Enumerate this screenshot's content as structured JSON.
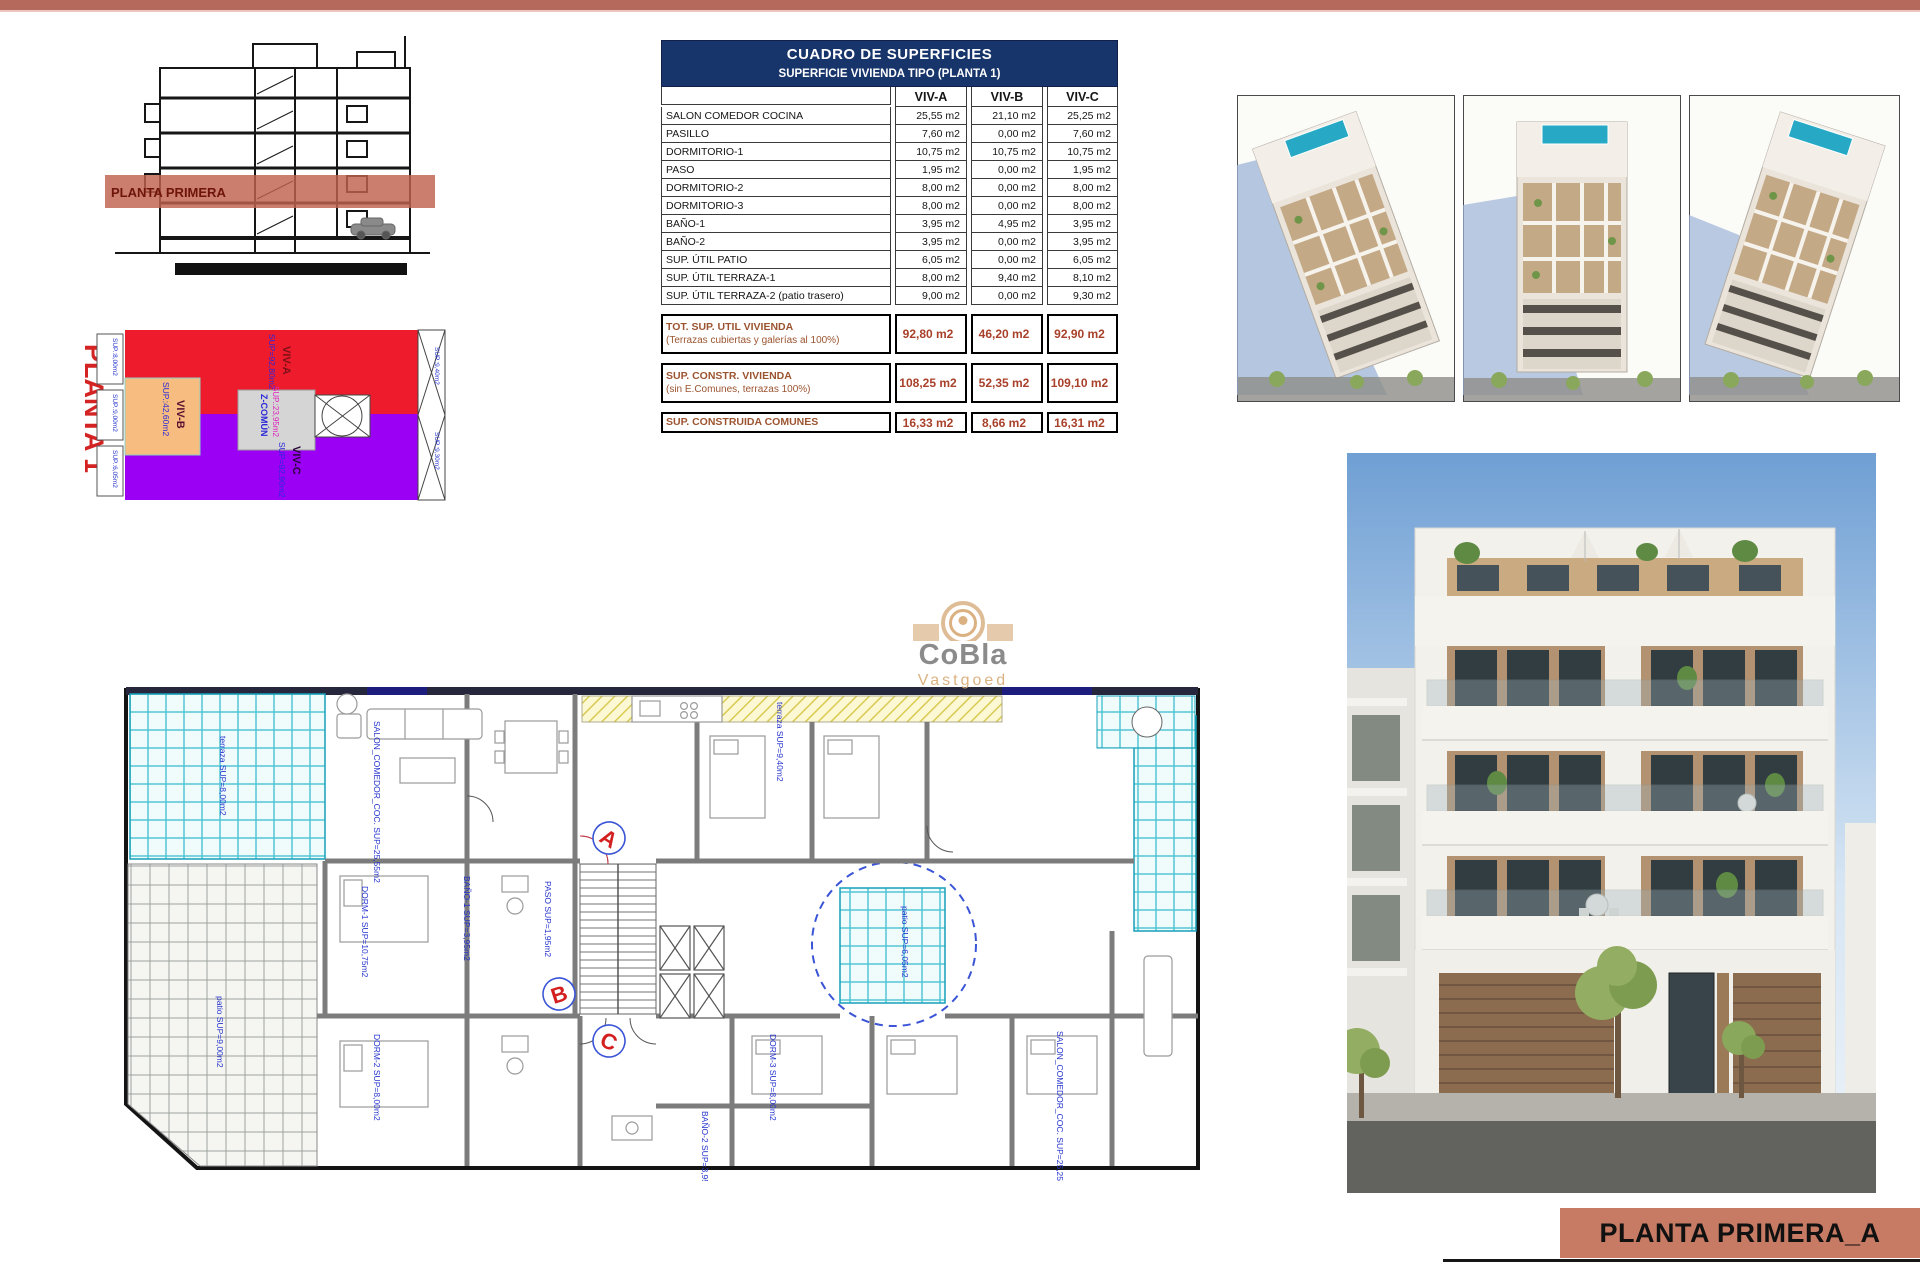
{
  "top_bar_color": "#b4695c",
  "section_drawing": {
    "label": "PLANTA PRIMERA"
  },
  "planta1": {
    "title": "PLANTA 1",
    "zones": [
      {
        "name": "VIV-A",
        "sup": "SUP=92,80m2",
        "color": "#ee1b2d"
      },
      {
        "name": "VIV-B",
        "sup": "SUP.:42,60m2",
        "color": "#f6bc80"
      },
      {
        "name": "VIV-C",
        "sup": "SUP=92,90m2",
        "color": "#9b00f5"
      },
      {
        "name": "Z-COMÚN",
        "sup": "SUP.:23,95m2",
        "color": "#d5d5d5"
      }
    ],
    "edge_labels": [
      "SUP.:8,00m2",
      "SUP.:9,00m2",
      "SUP.:6,05m2",
      "SUP.:9,40m2",
      "SUP.:9,30m2"
    ]
  },
  "table": {
    "title": "CUADRO DE SUPERFICIES",
    "subtitle": "SUPERFICIE VIVIENDA TIPO  (PLANTA 1)",
    "columns": [
      "VIV-A",
      "VIV-B",
      "VIV-C"
    ],
    "rows": [
      {
        "label": "SALON COMEDOR COCINA",
        "values": [
          "25,55 m2",
          "21,10 m2",
          "25,25 m2"
        ]
      },
      {
        "label": "PASILLO",
        "values": [
          "7,60 m2",
          "0,00 m2",
          "7,60 m2"
        ]
      },
      {
        "label": "DORMITORIO-1",
        "values": [
          "10,75 m2",
          "10,75 m2",
          "10,75 m2"
        ]
      },
      {
        "label": "PASO",
        "values": [
          "1,95 m2",
          "0,00 m2",
          "1,95 m2"
        ]
      },
      {
        "label": "DORMITORIO-2",
        "values": [
          "8,00 m2",
          "0,00 m2",
          "8,00 m2"
        ]
      },
      {
        "label": "DORMITORIO-3",
        "values": [
          "8,00 m2",
          "0,00 m2",
          "8,00 m2"
        ]
      },
      {
        "label": "BAÑO-1",
        "values": [
          "3,95 m2",
          "4,95 m2",
          "3,95 m2"
        ]
      },
      {
        "label": "BAÑO-2",
        "values": [
          "3,95 m2",
          "0,00 m2",
          "3,95 m2"
        ]
      },
      {
        "label": "SUP. ÚTIL PATIO",
        "values": [
          "6,05 m2",
          "0,00 m2",
          "6,05 m2"
        ]
      },
      {
        "label": "SUP. ÚTIL TERRAZA-1",
        "values": [
          "8,00 m2",
          "9,40 m2",
          "8,10 m2"
        ]
      },
      {
        "label": "SUP. ÚTIL TERRAZA-2 (patio trasero)",
        "values": [
          "9,00 m2",
          "0,00 m2",
          "9,30 m2"
        ]
      }
    ],
    "totals": [
      {
        "label": "TOT. SUP. UTIL VIVIENDA",
        "sublabel": "(Terrazas cubiertas y galerías al 100%)",
        "values": [
          "92,80 m2",
          "46,20 m2",
          "92,90 m2"
        ]
      },
      {
        "label": "SUP. CONSTR. VIVIENDA",
        "sublabel": "(sin E.Comunes, terrazas 100%)",
        "values": [
          "108,25 m2",
          "52,35 m2",
          "109,10 m2"
        ]
      },
      {
        "label": "SUP. CONSTRUIDA COMUNES",
        "sublabel": "",
        "values": [
          "16,33 m2",
          "8,66 m2",
          "16,31 m2"
        ]
      }
    ]
  },
  "floor_plan": {
    "unit_markers": [
      "A",
      "B",
      "C"
    ],
    "labels": [
      "terraza SUP=8,00m2",
      "SALON_COMEDOR_COC. SUP=25,55m2",
      "DORM-1 SUP=10,75m2",
      "BAÑO-1 SUP=3,95m2",
      "PASO SUP=1,95m2",
      "DORM-2 SUP=8,00m2",
      "DORM-3 SUP=8,00m2",
      "BAÑO-2 SUP=3,95m2",
      "patio SUP=6,05m2",
      "terraza SUP=9,40m2",
      "SALON_COMEDOR_COC. SUP=25,25m2",
      "patio SUP=9,00m2"
    ]
  },
  "watermark": {
    "line1": "CoBla",
    "line2": "Vastgoed"
  },
  "title_block": {
    "text": "PLANTA PRIMERA_A",
    "bg": "#c87b64"
  }
}
